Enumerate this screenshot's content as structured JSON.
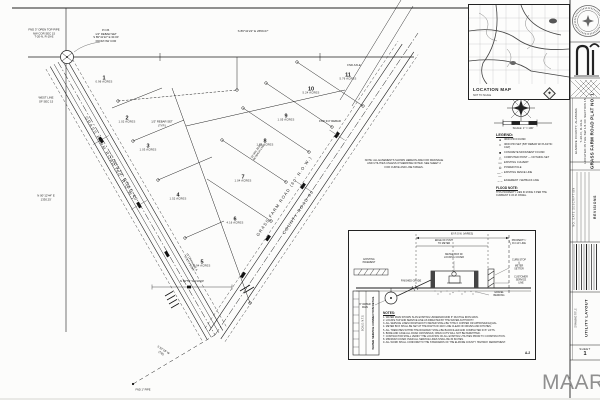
{
  "colors": {
    "paper": "#fcfcfb",
    "ink": "#1b1b1b",
    "watermark_gray": "#8f8f8f"
  },
  "watermark": {
    "text": "MAAR/MLS"
  },
  "title_block": {
    "project_title": "GRASS FARM ROAD PLAT NO. 1",
    "location_line1": "LOCATED IN THE SW 1/4 OF SECTION 15",
    "location_line2": "T-20-N, R-19-E",
    "location_line3": "ELMORE COUNTY, ALABAMA",
    "revisions_heading": "REVISIONS",
    "revisions_columns": "NO.   DATE   DESCRIPTION",
    "drawing_title_label": "DRAWING TITLE",
    "drawing_title": "UTILITY LAYOUT",
    "sheet_label": "SHEET",
    "sheet_number": "1"
  },
  "location_map": {
    "label": "LOCATION MAP",
    "sublabel": "NOT TO SCALE"
  },
  "scale_bar": {
    "caption": "SCALE: 1″ = 100′"
  },
  "legend": {
    "heading": "LEGEND:",
    "items": [
      {
        "sym": "●",
        "lbl": "IRON PIN FOUND"
      },
      {
        "sym": "□",
        "lbl": "IRON PIN SET (5/8″ REBAR W/ PLASTIC CAP)"
      },
      {
        "sym": "■",
        "lbl": "CONCRETE MONUMENT FOUND"
      },
      {
        "sym": "△",
        "lbl": "COMPUTED POINT — NOTHING SET"
      },
      {
        "sym": "▭",
        "lbl": "EXISTING CULVERT"
      },
      {
        "sym": "⊙",
        "lbl": "POWER POLE"
      },
      {
        "sym": "—··—",
        "lbl": "EXISTING FENCE LINE"
      },
      {
        "sym": "– –",
        "lbl": "EASEMENT / SETBACK LINE"
      }
    ],
    "flood_heading": "FLOOD NOTE:",
    "flood_text": "THIS PROPERTY LIES IN ZONE X PER THE CURRENT F.I.R.M. PANEL."
  },
  "lots": [
    {
      "n": "1",
      "a": "0.96 ACRES",
      "x": 104,
      "y": 80
    },
    {
      "n": "2",
      "a": "1.02 ACRES",
      "x": 127,
      "y": 120
    },
    {
      "n": "3",
      "a": "1.03 ACRES",
      "x": 148,
      "y": 148
    },
    {
      "n": "4",
      "a": "1.52 ACRES",
      "x": 178,
      "y": 197
    },
    {
      "n": "5",
      "a": "0.94 ACRES",
      "x": 202,
      "y": 264
    },
    {
      "n": "6",
      "a": "4.16 ACRES",
      "x": 235,
      "y": 221
    },
    {
      "n": "7",
      "a": "1.04 ACRES",
      "x": 243,
      "y": 179
    },
    {
      "n": "8",
      "a": "1.05 ACRES",
      "x": 265,
      "y": 143
    },
    {
      "n": "9",
      "a": "1.05 ACRES",
      "x": 286,
      "y": 118
    },
    {
      "n": "10",
      "a": "5.24 ACRES",
      "x": 311,
      "y": 91
    },
    {
      "n": "11",
      "a": "5.76 ACRES",
      "x": 348,
      "y": 77
    }
  ],
  "road_labels": [
    {
      "t": "GRASS FARM ROAD   (60′ R.O.W.)",
      "x": 110,
      "y": 158,
      "r": 60
    },
    {
      "t": "COUNTY ROAD 40",
      "x": 124,
      "y": 178,
      "r": 60
    },
    {
      "t": "GRASS FARM ROAD   (60′ R.O.W.)",
      "x": 284,
      "y": 196,
      "r": -56
    },
    {
      "t": "COUNTY ROAD 80",
      "x": 298,
      "y": 212,
      "r": -56
    }
  ],
  "annotations": [
    {
      "t": "S 89°41′22″ E   2659.07′",
      "x": 253,
      "y": 32,
      "s": 3
    },
    {
      "t": "FND 3″ OPEN TOP PIPE\nNW COR SEC 15\nT-20-N, R-19-E",
      "x": 44,
      "y": 34
    },
    {
      "t": "P.O.B.\n1/2″ REBAR SET\nS 89°41′22″ E  30.00′\nFROM NW COR",
      "x": 106,
      "y": 36
    },
    {
      "t": "WEST LINE\nOF SEC 15",
      "x": 46,
      "y": 100
    },
    {
      "t": "N 00°12′44″ E\n1330.25′",
      "x": 46,
      "y": 198
    },
    {
      "t": "1/2″ REBAR SET\n(TYP.)",
      "x": 162,
      "y": 124
    },
    {
      "t": "15′ DRAINAGE &\nUTILITY ESMT",
      "x": 190,
      "y": 263,
      "r": 60,
      "s": 2.6
    },
    {
      "t": "30′ MIN. BLDG\nSETBACK LINE",
      "x": 258,
      "y": 152,
      "r": -56,
      "s": 2.6
    },
    {
      "t": "FND 3/4″ REBAR",
      "x": 330,
      "y": 122
    },
    {
      "t": "FND AXLE",
      "x": 354,
      "y": 66
    },
    {
      "t": "NOTE: ALL EASEMENTS SHOWN HEREON ARE FOR DRAINAGE\nAND UTILITIES UNLESS OTHERWISE NOTED. SEE SHEET 2\nFOR CURVE AND LINE TABLES.",
      "x": 404,
      "y": 164,
      "s": 2.6
    },
    {
      "t": "N 89°55′ W  210.00′",
      "x": 192,
      "y": 282
    },
    {
      "t": "S 52°18′ W\n(TIE)",
      "x": 162,
      "y": 352,
      "r": 33
    },
    {
      "t": "FND 1″ PIPE",
      "x": 143,
      "y": 390,
      "s": 2.6
    }
  ],
  "detail_panel": {
    "notes_heading": "NOTES:",
    "notes": [
      {
        "t": "1. WATER MAIN SHOWN IS AN EXISTING UNDERGROUND 6″ DUCTILE IRON MAIN."
      },
      {
        "t": "2. LOCATE TAP AND SERVICE LINE AS DIRECTED BY THE WATER AUTHORITY."
      },
      {
        "t": "3. ALL SERVICE LINES FROM MAIN TO METER SHALL BE TYPE K COPPER OR APPROVED EQUAL."
      },
      {
        "t": "4. METER BOX SHALL BE SET AT THE RIGHT-OF-WAY LINE CLEAR OF DRIVES AND DITCHES."
      },
      {
        "t": "5. ALL TRENCHES WITHIN THE ROADWAY SHALL BE BACKFILLED AND COMPACTED IN 6″ LIFTS."
      },
      {
        "t": "6. BORE AND CASE ALL ROAD CROSSINGS; OPEN CUTS WILL NOT BE PERMITTED."
      },
      {
        "t": "7. CONTRACTOR SHALL VERIFY THE LOCATION OF ALL EXISTING UTILITIES PRIOR TO CONSTRUCTION."
      },
      {
        "t": "8. MINIMUM COVER OVER ALL SERVICE LINES SHALL BE 30 INCHES."
      },
      {
        "t": "9. ALL WORK SHALL CONFORM TO THE STANDARDS OF THE ELMORE COUNTY HIGHWAY DEPARTMENT."
      }
    ],
    "labels": [
      {
        "t": "60′ R.O.W. (VARIES)",
        "x": 113,
        "y": 4
      },
      {
        "t": "EDGE OF PVMT\nTO METER",
        "x": 95,
        "y": 12
      },
      {
        "t": "METER BOX W/\nLOCKING COVER",
        "x": 105,
        "y": 26
      },
      {
        "t": "PROPERTY /\nR.O.W. LINE",
        "x": 170,
        "y": 12
      },
      {
        "t": "CURB STOP &\nMETER SETTER",
        "x": 170,
        "y": 34
      },
      {
        "t": "CUSTOMER\nSERVICE LINE",
        "x": 172,
        "y": 50
      },
      {
        "t": "EXISTING\nPAVEMENT",
        "x": 20,
        "y": 31
      },
      {
        "t": "FINISHED GRADE",
        "x": 62,
        "y": 51
      },
      {
        "t": "6″ WATER\nMAIN",
        "x": 16,
        "y": 76
      },
      {
        "t": "GRAVEL\nBEDDING",
        "x": 150,
        "y": 64
      }
    ],
    "side_title": "WATER SERVICE CONNECTION DETAIL",
    "side_sub": "SCALE: N.T.S.",
    "ref": "A-2"
  }
}
